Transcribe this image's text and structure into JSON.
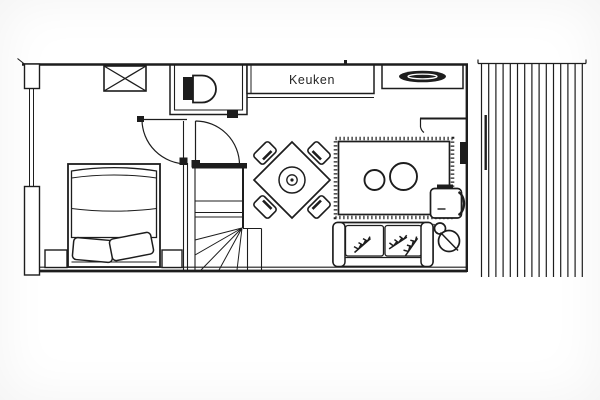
{
  "colors": {
    "background": "#ffffff",
    "ink": "#1d1d1d",
    "label_text": "#262626"
  },
  "labels": {
    "kitchen": "Keuken"
  },
  "icons": [
    {
      "name": "wardrobe-icon",
      "glyph": "crossed-box"
    },
    {
      "name": "toilet-icon",
      "glyph": "tank-and-bowl"
    },
    {
      "name": "kitchen-sink-icon",
      "glyph": "dark-lens"
    },
    {
      "name": "window-icon",
      "glyph": "double-line"
    },
    {
      "name": "door-icon",
      "glyph": "quarter-circle-swing"
    },
    {
      "name": "staircase-icon",
      "glyph": "winder-stairs"
    },
    {
      "name": "double-bed-icon",
      "glyph": "bed-with-two-pillows"
    },
    {
      "name": "nightstand-icon",
      "glyph": "small-square"
    },
    {
      "name": "dining-table-icon",
      "glyph": "diamond-table-round-centerpiece"
    },
    {
      "name": "dining-chair-icon",
      "glyph": "rotated-seat"
    },
    {
      "name": "rug-icon",
      "glyph": "fringed-rect-two-circles"
    },
    {
      "name": "sofa-icon",
      "glyph": "two-seat-sofa"
    },
    {
      "name": "plant-sprig-icon",
      "glyph": "leaf-branch"
    },
    {
      "name": "floor-lamp-icon",
      "glyph": "circle-with-slash"
    },
    {
      "name": "side-table-icon",
      "glyph": "rounded-square"
    },
    {
      "name": "radiator-icon",
      "glyph": "filled-bar"
    },
    {
      "name": "terrace-decking-icon",
      "glyph": "vertical-planks"
    }
  ]
}
